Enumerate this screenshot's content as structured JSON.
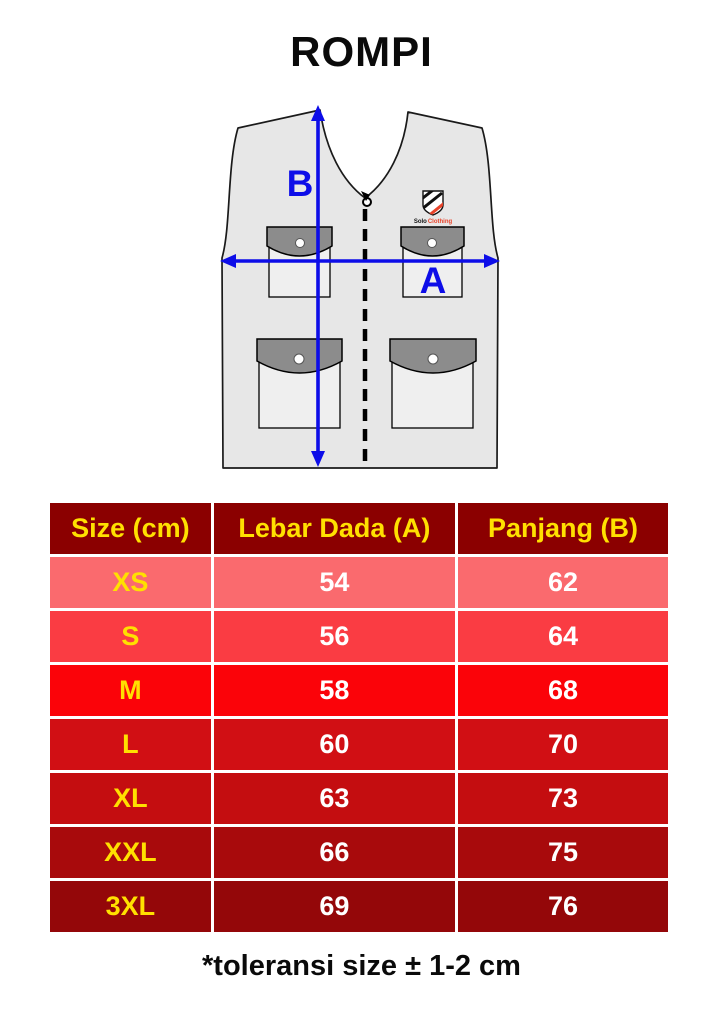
{
  "page": {
    "title": "ROMPI",
    "footer_note": "*toleransi size ± 1-2 cm"
  },
  "theme": {
    "arrow-color": "#0D0DE8",
    "vest-fill": "#E7E7E7",
    "pocket-fill": "#EFEFEF",
    "flap-fill": "#8C8C8C",
    "vest-outline": "#1A1A1A",
    "header-bg": "#8B0000",
    "accent-yellow": "#FFE000",
    "value-white": "#FFFFFF",
    "logo-red": "#E8432A",
    "text-black": "#0A0A0A"
  },
  "diagram": {
    "width_label": "A",
    "length_label": "B",
    "logo_text_1": "Solo",
    "logo_text_2": "Clothing"
  },
  "size_chart": {
    "headers": [
      "Size (cm)",
      "Lebar Dada (A)",
      "Panjang (B)"
    ],
    "rows": [
      {
        "size": "XS",
        "lebar_dada": "54",
        "panjang": "62",
        "bg": "#FA6A6E"
      },
      {
        "size": "S",
        "lebar_dada": "56",
        "panjang": "64",
        "bg": "#FA3C43"
      },
      {
        "size": "M",
        "lebar_dada": "58",
        "panjang": "68",
        "bg": "#FB0309"
      },
      {
        "size": "L",
        "lebar_dada": "60",
        "panjang": "70",
        "bg": "#D10F14"
      },
      {
        "size": "XL",
        "lebar_dada": "63",
        "panjang": "73",
        "bg": "#C40D10"
      },
      {
        "size": "XXL",
        "lebar_dada": "66",
        "panjang": "75",
        "bg": "#A80A0C"
      },
      {
        "size": "3XL",
        "lebar_dada": "69",
        "panjang": "76",
        "bg": "#940709"
      }
    ]
  }
}
